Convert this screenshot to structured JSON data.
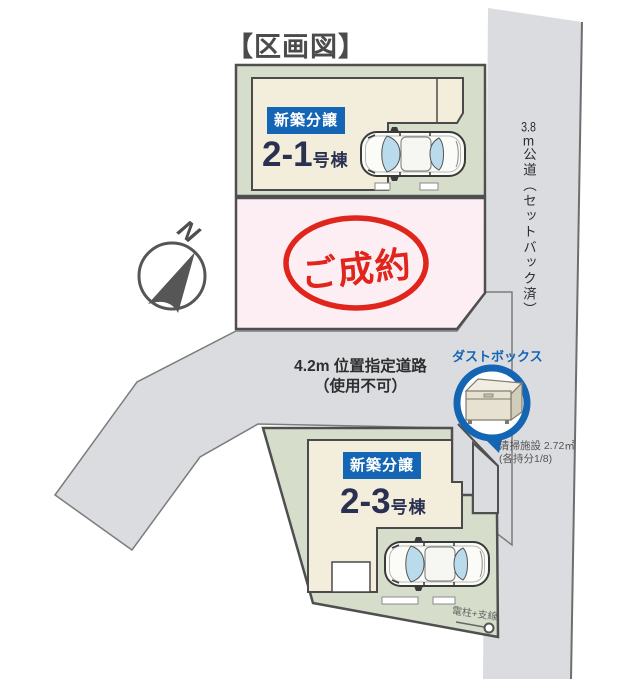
{
  "title": "【区画図】",
  "compass": {
    "label": "N"
  },
  "roads": {
    "east": {
      "size": "3.8",
      "unit": "m",
      "label": "公道（セットバック済）"
    },
    "front": {
      "line1": "4.2m 位置指定道路",
      "line2": "（使用不可）"
    }
  },
  "lots": {
    "lot_2_1": {
      "badge": "新築分譲",
      "number": "2-1",
      "suffix": "号棟"
    },
    "lot_sold": {
      "stamp": "ご成約"
    },
    "lot_2_3": {
      "badge": "新築分譲",
      "number": "2-3",
      "suffix": "号棟"
    }
  },
  "dustbox": {
    "label": "ダストボックス",
    "note_line1": "清掃施設 2.72㎡",
    "note_line2": "(各持分1/8)"
  },
  "pole": {
    "label": "電柱+支線"
  },
  "colors": {
    "badge_blue": "#1465b4",
    "stamp_red": "#e0251c",
    "lot_green": "#d6decb",
    "building_beige": "#f3eddc",
    "sold_pink": "#fdeef3",
    "road_gray": "#dbdcdf",
    "text_navy": "#2a3150"
  }
}
